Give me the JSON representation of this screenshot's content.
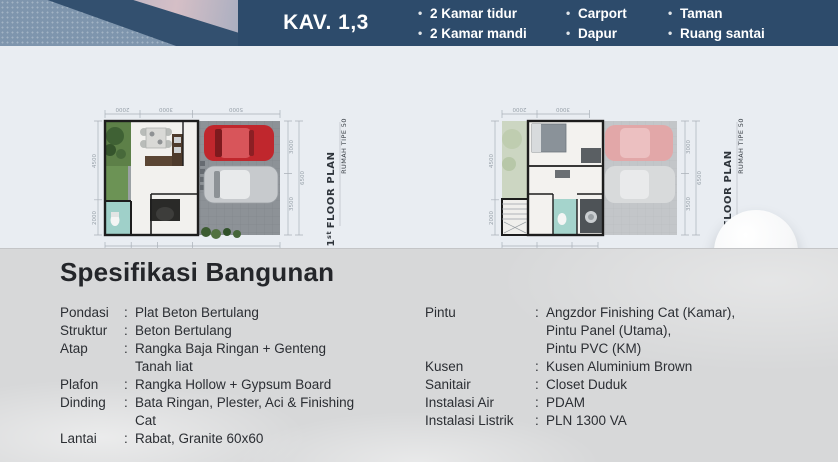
{
  "colors": {
    "header_bg": "#2d4b6b",
    "plans_bg": "#e9edf2",
    "specs_bg": "#d7d8d9",
    "text_dark": "#24262a",
    "red_car": "#c0272d",
    "bathroom_teal": "#9fd0c9",
    "garden_green": "#5d8048"
  },
  "header": {
    "kav_label": "KAV. 1,3",
    "bullet": "•",
    "features": [
      [
        "2 Kamar tidur",
        "2 Kamar mandi"
      ],
      [
        "Carport",
        "Dapur"
      ],
      [
        "Taman",
        "Ruang santai"
      ]
    ]
  },
  "plans": [
    {
      "title_num": "1",
      "title_sup": "st",
      "title_rest": "FLOOR PLAN",
      "subtitle": "RUMAH TIPE 50",
      "dims_top": [
        "2000",
        "3000",
        "5000"
      ],
      "dims_left": [
        "4500",
        "2000"
      ],
      "dims_right": [
        "3000",
        "3500"
      ],
      "dims_right_total": "6500",
      "dims_bottom": [
        "1500",
        "1500",
        "2000",
        "5000"
      ],
      "dims_bottom_total": "10000"
    },
    {
      "title_num": "2",
      "title_sup": "nd",
      "title_rest": "FLOOR PLAN",
      "subtitle": "RUMAH TIPE 50",
      "dims_top": [
        "2000",
        "3000"
      ],
      "dims_left": [
        "4500",
        "2000"
      ],
      "dims_right": [
        "3000",
        "3500"
      ],
      "dims_right_total": "6500",
      "dims_bottom": [
        "2000",
        "2000",
        "1500"
      ]
    }
  ],
  "specs": {
    "title": "Spesifikasi Bangunan",
    "colon": ":",
    "left": [
      {
        "label": "Pondasi",
        "value": "Plat Beton Bertulang"
      },
      {
        "label": "Struktur",
        "value": "Beton Bertulang"
      },
      {
        "label": "Atap",
        "value": "Rangka Baja Ringan + Genteng\nTanah liat"
      },
      {
        "label": "Plafon",
        "value": "Rangka Hollow + Gypsum Board"
      },
      {
        "label": "Dinding",
        "value": "Bata Ringan, Plester, Aci & Finishing\nCat"
      },
      {
        "label": "Lantai",
        "value": "Rabat, Granite 60x60"
      }
    ],
    "right": [
      {
        "label": "Pintu",
        "value": "Angzdor Finishing Cat (Kamar),\nPintu Panel (Utama),\nPintu PVC (KM)"
      },
      {
        "label": "Kusen",
        "value": "Kusen Aluminium Brown"
      },
      {
        "label": "Sanitair",
        "value": "Closet Duduk"
      },
      {
        "label": "Instalasi Air",
        "value": "PDAM"
      },
      {
        "label": "Instalasi Listrik",
        "value": "PLN 1300 VA"
      }
    ]
  }
}
